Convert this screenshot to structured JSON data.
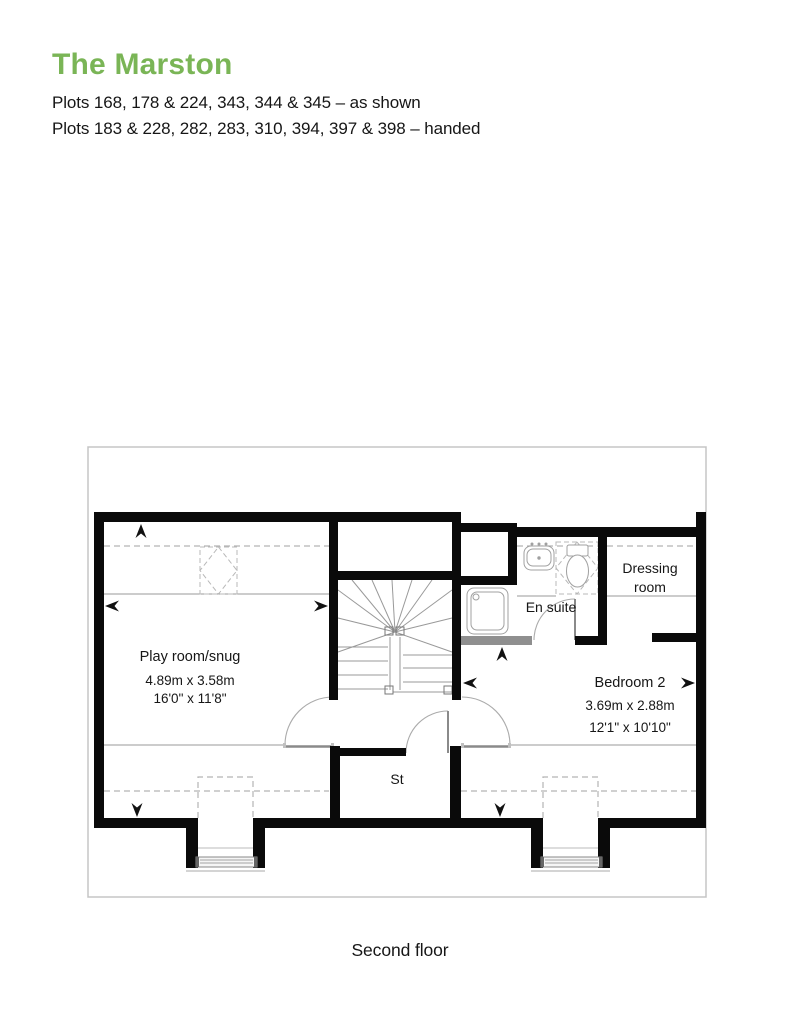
{
  "header": {
    "title": "The Marston",
    "plots_as_shown": "Plots 168, 178 & 224, 343, 344 & 345 – as shown",
    "plots_handed": "Plots 183 & 228, 282, 283, 310, 394, 397 & 398 – handed"
  },
  "plan": {
    "rooms": {
      "playroom": {
        "name": "Play room/snug",
        "metric": "4.89m x 3.58m",
        "imperial": "16'0\" x 11'8\""
      },
      "bedroom2": {
        "name": "Bedroom 2",
        "metric": "3.69m x 2.88m",
        "imperial": "12'1\" x 10'10\""
      },
      "ensuite": {
        "name": "En suite"
      },
      "dressing": {
        "line1": "Dressing",
        "line2": "room"
      },
      "store": {
        "abbr": "St"
      }
    },
    "floor_caption": "Second floor"
  },
  "colors": {
    "accent_green": "#7ab556",
    "wall_black": "#0a0a0a",
    "text_dark": "#161616",
    "thin_line_gray": "#999999",
    "dashed_gray": "#b3b3b3",
    "roof_outline_gray": "#c5c5c5"
  }
}
